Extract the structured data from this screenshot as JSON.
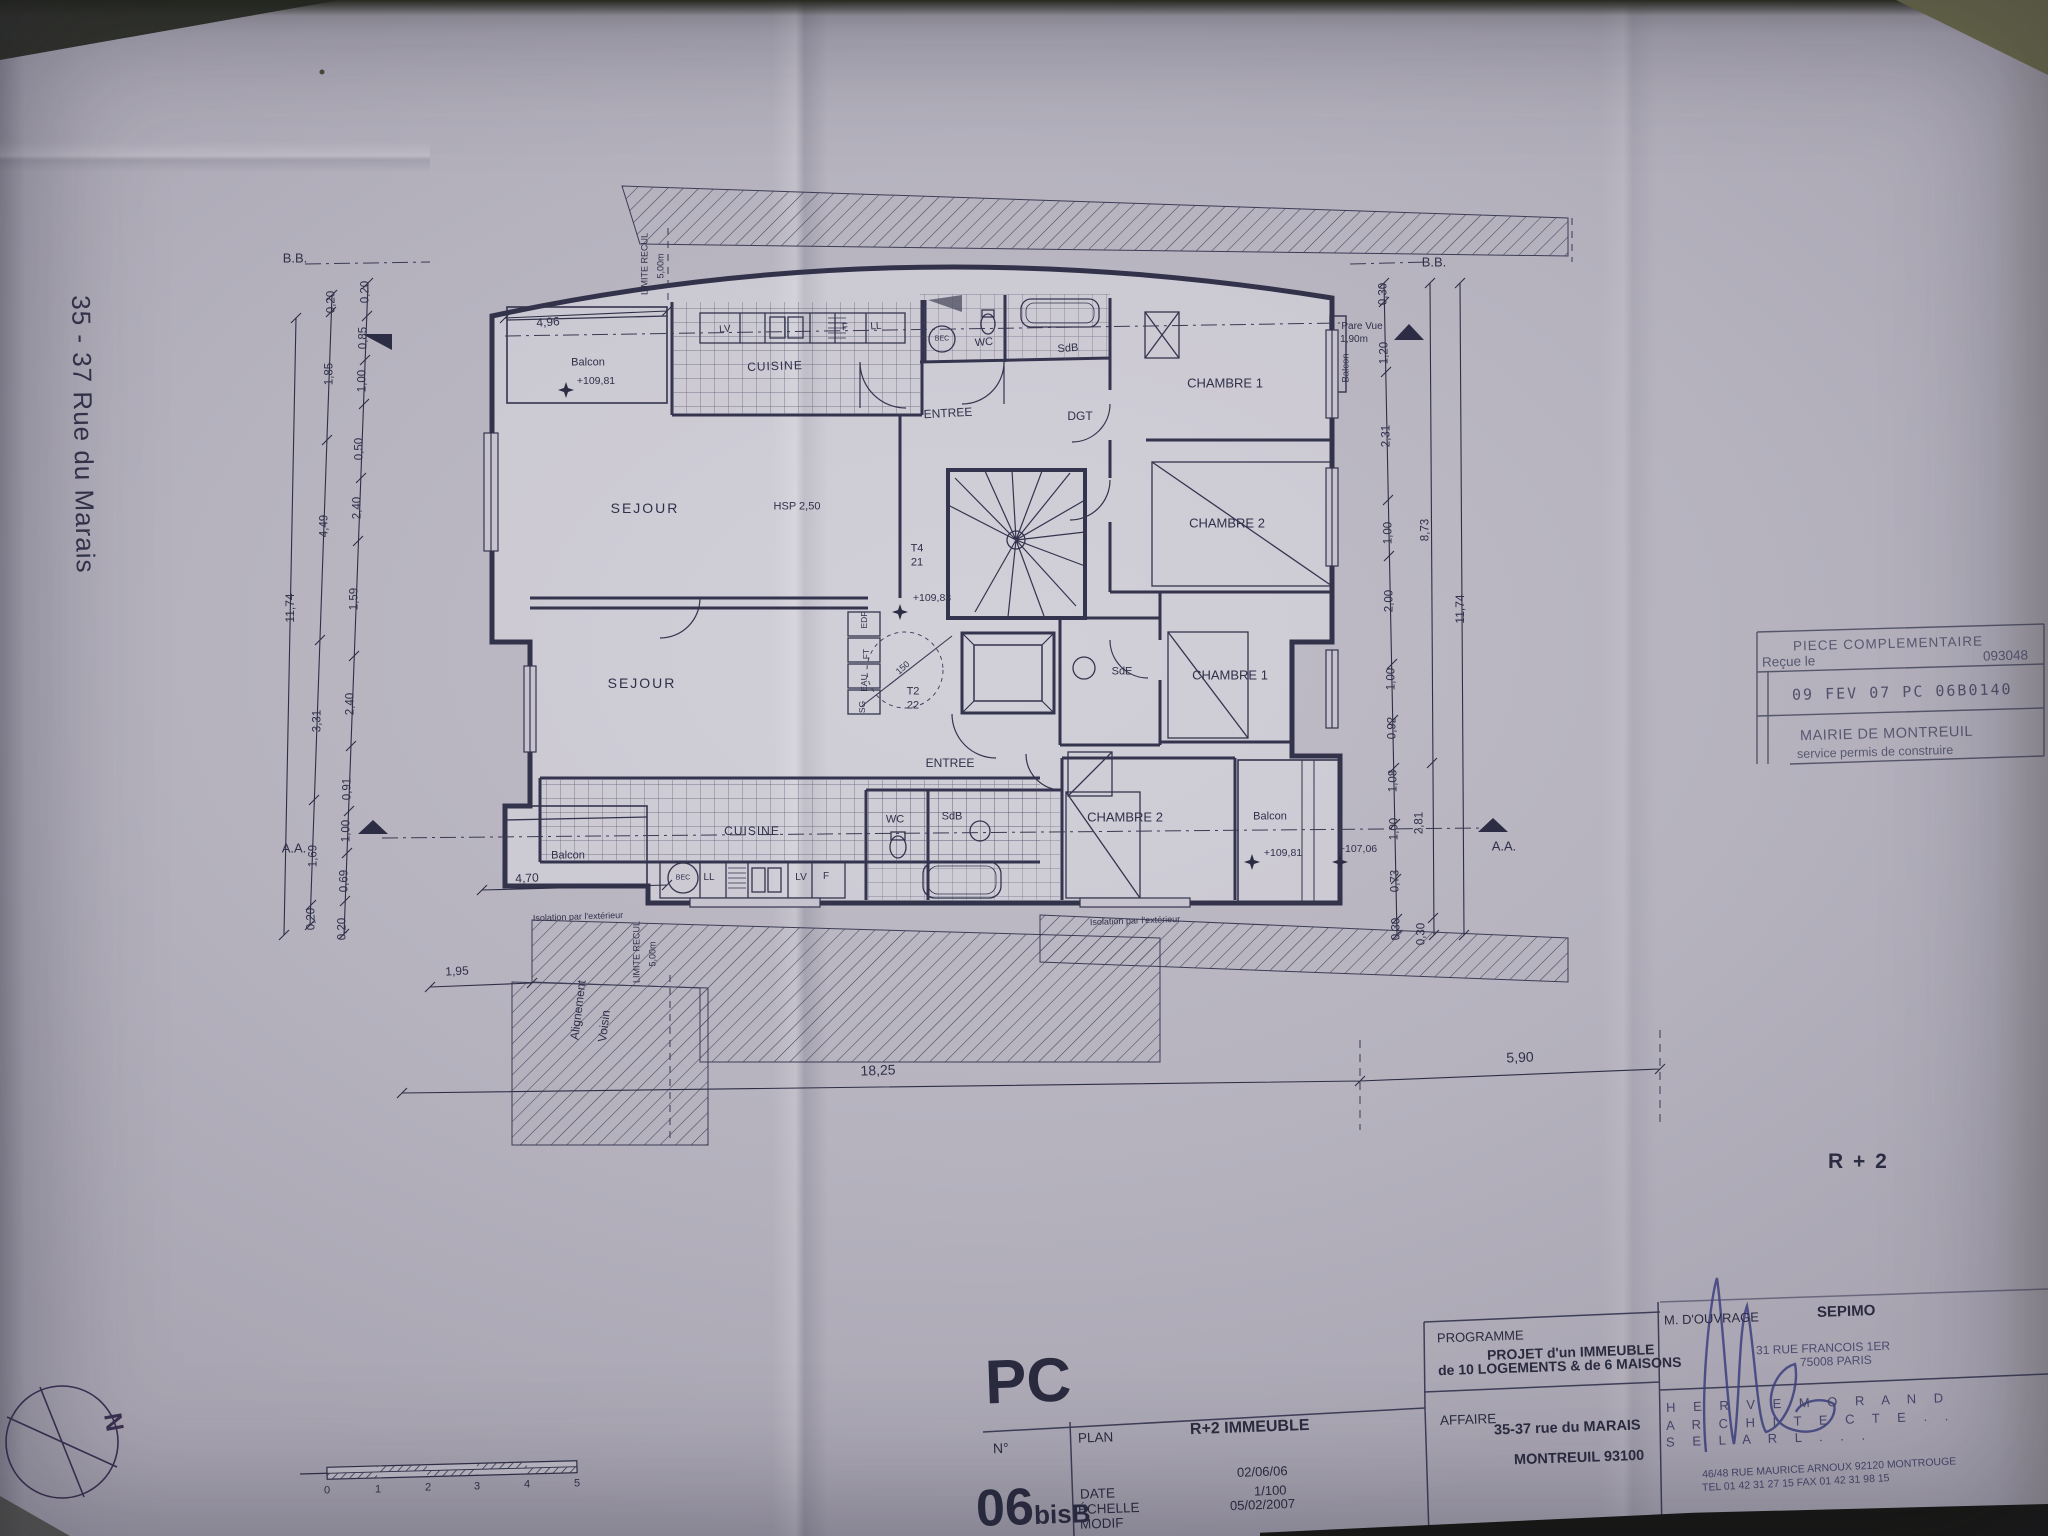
{
  "colors": {
    "paper": "#b6b3bf",
    "ink": "#32324a",
    "stamp_ink": "#585870",
    "signature_ink": "#3c3f7e"
  },
  "margin_labels": {
    "street": "35 - 37 Rue du Marais",
    "floor_ref": "R + 2",
    "north": "N"
  },
  "stamp": {
    "title": "PIECE COMPLEMENTAIRE",
    "received_label": "Reçue le",
    "number": "093048",
    "date_stamp": "09 FEV 07 PC 06B0140",
    "authority": "MAIRIE DE MONTREUIL",
    "service": "service permis de construire"
  },
  "titleblock": {
    "doc_type": "PC",
    "num_label": "N°",
    "num_big": "06",
    "num_small": "bisB",
    "plan_label": "PLAN",
    "date_label": "DATE",
    "echelle_label": "ÉCHELLE",
    "modif_label": "MODIF",
    "plan_value": "R+2 IMMEUBLE",
    "date_value": "02/06/06",
    "echelle_value": "1/100",
    "modif_value": "05/02/2007",
    "programme_label": "PROGRAMME",
    "programme_line1": "PROJET d'un IMMEUBLE",
    "programme_line2": "de 10 LOGEMENTS & de 6 MAISONS",
    "affaire_label": "AFFAIRE",
    "affaire_line1": "35-37 rue du MARAIS",
    "affaire_line2": "MONTREUIL 93100",
    "owner_label": "M. D'OUVRAGE",
    "owner_name": "SEPIMO",
    "owner_addr1": "31 RUE FRANCOIS 1ER",
    "owner_addr2": "75008 PARIS",
    "architect_line1": "H E R V E    M O R A N D",
    "architect_line2": "A R C H I T E C T E   .   .",
    "architect_line3": "S E L   A R L   .   .   .",
    "architect_addr": "46/48 RUE MAURICE ARNOUX 92120 MONTROUGE",
    "architect_tel": "TEL 01 42 31 27 15    FAX 01 42 31 98 15"
  },
  "scale_bar": {
    "ticks": [
      {
        "t": "0",
        "x": 327,
        "y": 1491,
        "s": 11
      },
      {
        "t": "1",
        "x": 378,
        "y": 1490,
        "s": 11
      },
      {
        "t": "2",
        "x": 428,
        "y": 1488,
        "s": 11
      },
      {
        "t": "3",
        "x": 477,
        "y": 1487,
        "s": 11
      },
      {
        "t": "4",
        "x": 527,
        "y": 1485,
        "s": 11
      },
      {
        "t": "5",
        "x": 577,
        "y": 1484,
        "s": 11
      }
    ]
  },
  "plan": {
    "labels": [
      {
        "t": "SEJOUR",
        "x": 645,
        "y": 508,
        "s": 14,
        "sp": 2
      },
      {
        "t": "SEJOUR",
        "x": 642,
        "y": 683,
        "s": 14,
        "sp": 2
      },
      {
        "t": "CUISINE",
        "x": 775,
        "y": 366,
        "s": 12,
        "sp": 1,
        "r": -2
      },
      {
        "t": "CUISINE",
        "x": 752,
        "y": 831,
        "s": 12,
        "sp": 1
      },
      {
        "t": "CHAMBRE 1",
        "x": 1225,
        "y": 383,
        "s": 13
      },
      {
        "t": "CHAMBRE 2",
        "x": 1227,
        "y": 523,
        "s": 13
      },
      {
        "t": "CHAMBRE 1",
        "x": 1230,
        "y": 675,
        "s": 13
      },
      {
        "t": "CHAMBRE 2",
        "x": 1125,
        "y": 817,
        "s": 13
      },
      {
        "t": "ENTREE",
        "x": 948,
        "y": 413,
        "s": 12,
        "r": -3
      },
      {
        "t": "ENTREE",
        "x": 950,
        "y": 763,
        "s": 12
      },
      {
        "t": "DGT",
        "x": 1080,
        "y": 416,
        "s": 12
      },
      {
        "t": "WC",
        "x": 984,
        "y": 343,
        "s": 11,
        "r": -5
      },
      {
        "t": "WC",
        "x": 895,
        "y": 820,
        "s": 11
      },
      {
        "t": "SdB",
        "x": 1068,
        "y": 349,
        "s": 11,
        "r": -4
      },
      {
        "t": "SdB",
        "x": 952,
        "y": 817,
        "s": 11
      },
      {
        "t": "SdE",
        "x": 1122,
        "y": 672,
        "s": 11
      },
      {
        "t": "Balcon",
        "x": 588,
        "y": 363,
        "s": 11
      },
      {
        "t": "Balcon",
        "x": 568,
        "y": 856,
        "s": 11
      },
      {
        "t": "Balcon",
        "x": 1270,
        "y": 817,
        "s": 11
      },
      {
        "t": "Balcon",
        "x": 1346,
        "y": 368,
        "s": 9.5,
        "r": -90
      },
      {
        "t": "+109,81",
        "x": 596,
        "y": 381,
        "s": 10.5
      },
      {
        "t": "+109,83",
        "x": 932,
        "y": 598,
        "s": 10.5
      },
      {
        "t": "+109,81",
        "x": 1283,
        "y": 853,
        "s": 10.5
      },
      {
        "t": "+107,06",
        "x": 1358,
        "y": 849,
        "s": 10.5
      },
      {
        "t": "HSP 2,50",
        "x": 797,
        "y": 507,
        "s": 11
      },
      {
        "t": "T4",
        "x": 917,
        "y": 549,
        "s": 11
      },
      {
        "t": "21",
        "x": 917,
        "y": 563,
        "s": 11
      },
      {
        "t": "T2",
        "x": 913,
        "y": 692,
        "s": 11
      },
      {
        "t": "22",
        "x": 913,
        "y": 706,
        "s": 11
      },
      {
        "t": "150",
        "x": 903,
        "y": 668,
        "s": 9,
        "r": -42
      },
      {
        "t": "LV",
        "x": 725,
        "y": 330,
        "s": 10,
        "r": -4
      },
      {
        "t": "F",
        "x": 845,
        "y": 328,
        "s": 10,
        "r": -4
      },
      {
        "t": "LL",
        "x": 876,
        "y": 327,
        "s": 10,
        "r": -4
      },
      {
        "t": "BEC",
        "x": 942,
        "y": 339,
        "s": 7
      },
      {
        "t": "BEC",
        "x": 683,
        "y": 878,
        "s": 7
      },
      {
        "t": "LL",
        "x": 709,
        "y": 878,
        "s": 10
      },
      {
        "t": "LV",
        "x": 801,
        "y": 878,
        "s": 10
      },
      {
        "t": "F",
        "x": 826,
        "y": 877,
        "s": 10
      },
      {
        "t": "EDF",
        "x": 864,
        "y": 620,
        "s": 8.5,
        "r": -90
      },
      {
        "t": "FT",
        "x": 866,
        "y": 654,
        "s": 8.5,
        "r": -90
      },
      {
        "t": "EAU",
        "x": 864,
        "y": 683,
        "s": 8.5,
        "r": -90
      },
      {
        "t": "SG",
        "x": 862,
        "y": 707,
        "s": 8.5,
        "r": -90
      },
      {
        "t": "Pare Vue",
        "x": 1362,
        "y": 327,
        "s": 10
      },
      {
        "t": "1,90m",
        "x": 1354,
        "y": 340,
        "s": 10
      },
      {
        "t": "LIMITE RECUL",
        "x": 645,
        "y": 264,
        "s": 9,
        "r": -90
      },
      {
        "t": "5,00m",
        "x": 661,
        "y": 266,
        "s": 9,
        "r": -90
      },
      {
        "t": "LIMITE RECUL",
        "x": 637,
        "y": 952,
        "s": 9,
        "r": -90
      },
      {
        "t": "5,00m",
        "x": 653,
        "y": 954,
        "s": 9,
        "r": -90
      },
      {
        "t": "Alignement",
        "x": 578,
        "y": 1010,
        "s": 12,
        "r": -83
      },
      {
        "t": "Voisin",
        "x": 604,
        "y": 1026,
        "s": 12,
        "r": -83
      },
      {
        "t": "Isolation par l'extérieur",
        "x": 578,
        "y": 917,
        "s": 9,
        "r": -2
      },
      {
        "t": "Isolation par l'extérieur",
        "x": 1135,
        "y": 921,
        "s": 9,
        "r": -2
      },
      {
        "t": "B.B.",
        "x": 295,
        "y": 258,
        "s": 13
      },
      {
        "t": "B.B.",
        "x": 1434,
        "y": 262,
        "s": 13
      },
      {
        "t": "A.A.",
        "x": 294,
        "y": 848,
        "s": 13
      },
      {
        "t": "A.A.",
        "x": 1504,
        "y": 846,
        "s": 13
      },
      {
        "t": "4,96",
        "x": 548,
        "y": 322,
        "s": 12,
        "r": -4
      },
      {
        "t": "4,70",
        "x": 527,
        "y": 878,
        "s": 12,
        "r": -3
      },
      {
        "t": "1,95",
        "x": 457,
        "y": 971,
        "s": 12,
        "r": -3
      },
      {
        "t": "18,25",
        "x": 878,
        "y": 1070,
        "s": 14,
        "r": -2
      },
      {
        "t": "5,90",
        "x": 1520,
        "y": 1057,
        "s": 14,
        "r": -2
      },
      {
        "t": "0,20",
        "x": 366,
        "y": 292,
        "s": 11.5,
        "r": -90
      },
      {
        "t": "0,85",
        "x": 364,
        "y": 338,
        "s": 11.5,
        "r": -90
      },
      {
        "t": "1,00",
        "x": 363,
        "y": 381,
        "s": 11.5,
        "r": -90
      },
      {
        "t": "0,50",
        "x": 360,
        "y": 449,
        "s": 11.5,
        "r": -90
      },
      {
        "t": "2,40",
        "x": 358,
        "y": 508,
        "s": 11.5,
        "r": -90
      },
      {
        "t": "1,59",
        "x": 355,
        "y": 599,
        "s": 11.5,
        "r": -90
      },
      {
        "t": "2,40",
        "x": 351,
        "y": 704,
        "s": 11.5,
        "r": -90
      },
      {
        "t": "0,91",
        "x": 348,
        "y": 789,
        "s": 11.5,
        "r": -90
      },
      {
        "t": "1,00",
        "x": 347,
        "y": 831,
        "s": 11.5,
        "r": -90
      },
      {
        "t": "0,69",
        "x": 345,
        "y": 881,
        "s": 11.5,
        "r": -90
      },
      {
        "t": "0,20",
        "x": 343,
        "y": 929,
        "s": 11.5,
        "r": -90
      },
      {
        "t": "0,20",
        "x": 332,
        "y": 302,
        "s": 11.5,
        "r": -90
      },
      {
        "t": "1,85",
        "x": 330,
        "y": 374,
        "s": 11.5,
        "r": -90
      },
      {
        "t": "4,49",
        "x": 325,
        "y": 526,
        "s": 11.5,
        "r": -90
      },
      {
        "t": "3,31",
        "x": 318,
        "y": 721,
        "s": 11.5,
        "r": -90
      },
      {
        "t": "1,69",
        "x": 314,
        "y": 856,
        "s": 11.5,
        "r": -90
      },
      {
        "t": "0,20",
        "x": 312,
        "y": 919,
        "s": 11.5,
        "r": -90
      },
      {
        "t": "11,74",
        "x": 290,
        "y": 608,
        "s": 12,
        "r": -90
      },
      {
        "t": "0,30",
        "x": 1384,
        "y": 294,
        "s": 11.5,
        "r": -90
      },
      {
        "t": "1,20",
        "x": 1385,
        "y": 353,
        "s": 11.5,
        "r": -90
      },
      {
        "t": "2,31",
        "x": 1387,
        "y": 436,
        "s": 11.5,
        "r": -90
      },
      {
        "t": "1,00",
        "x": 1389,
        "y": 533,
        "s": 11.5,
        "r": -90
      },
      {
        "t": "2,00",
        "x": 1390,
        "y": 601,
        "s": 11.5,
        "r": -90
      },
      {
        "t": "1,00",
        "x": 1392,
        "y": 679,
        "s": 11.5,
        "r": -90
      },
      {
        "t": "0,92",
        "x": 1393,
        "y": 728,
        "s": 11.5,
        "r": -90
      },
      {
        "t": "1,08",
        "x": 1394,
        "y": 781,
        "s": 11.5,
        "r": -90
      },
      {
        "t": "1,00",
        "x": 1395,
        "y": 829,
        "s": 11.5,
        "r": -90
      },
      {
        "t": "0,73",
        "x": 1396,
        "y": 881,
        "s": 11.5,
        "r": -90
      },
      {
        "t": "0,30",
        "x": 1397,
        "y": 929,
        "s": 11.5,
        "r": -90
      },
      {
        "t": "8,73",
        "x": 1426,
        "y": 530,
        "s": 11.5,
        "r": -90
      },
      {
        "t": "2,81",
        "x": 1420,
        "y": 823,
        "s": 11.5,
        "r": -90
      },
      {
        "t": "0,30",
        "x": 1422,
        "y": 934,
        "s": 11.5,
        "r": -90
      },
      {
        "t": "11,74",
        "x": 1460,
        "y": 609,
        "s": 12,
        "r": -90
      }
    ]
  }
}
